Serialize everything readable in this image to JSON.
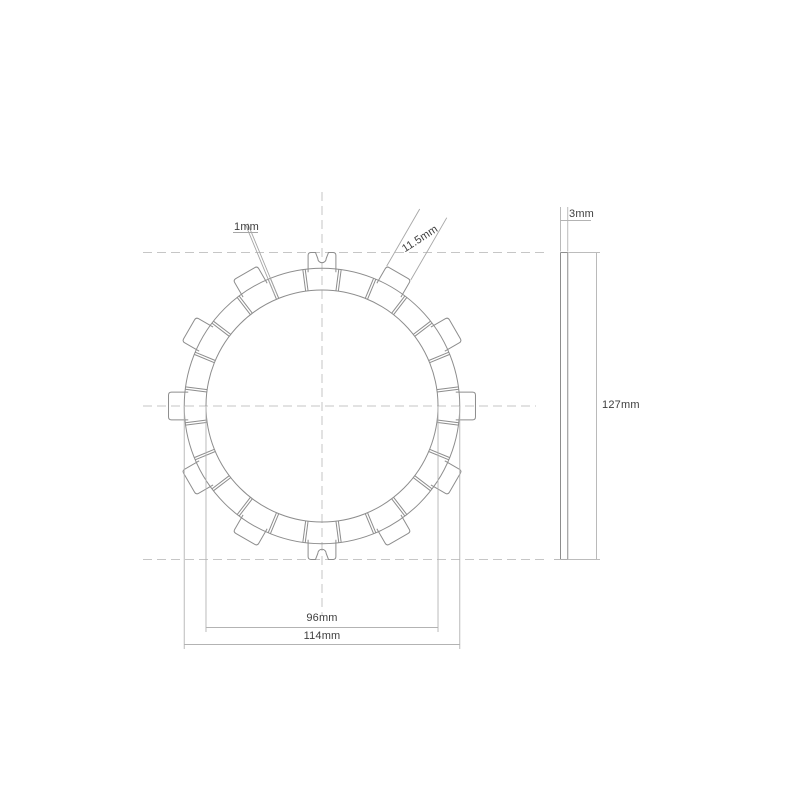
{
  "drawing": {
    "type": "clutch-friction-plate-technical-drawing",
    "labels": {
      "slot_width": "1mm",
      "tab_width": "11.5mm",
      "thickness": "3mm",
      "overall_diameter": "127mm",
      "friction_inner_diameter": "96mm",
      "friction_outer_diameter": "114mm"
    },
    "dimensions_mm": {
      "slot_width": 1,
      "tab_width": 11.5,
      "thickness": 3,
      "overall_diameter": 127,
      "friction_inner_diameter": 96,
      "friction_outer_diameter": 114
    },
    "features": {
      "pad_segments": 24,
      "drive_tabs": 12,
      "notched_tabs": [
        "top",
        "bottom"
      ]
    },
    "colors": {
      "outline": "#8d8d8d",
      "centerline": "#c6c6c6",
      "dimension_line": "#b3b3b3",
      "leader_line": "#a6a6a6",
      "label_text": "#3e3e3e",
      "background": "#ffffff"
    }
  }
}
